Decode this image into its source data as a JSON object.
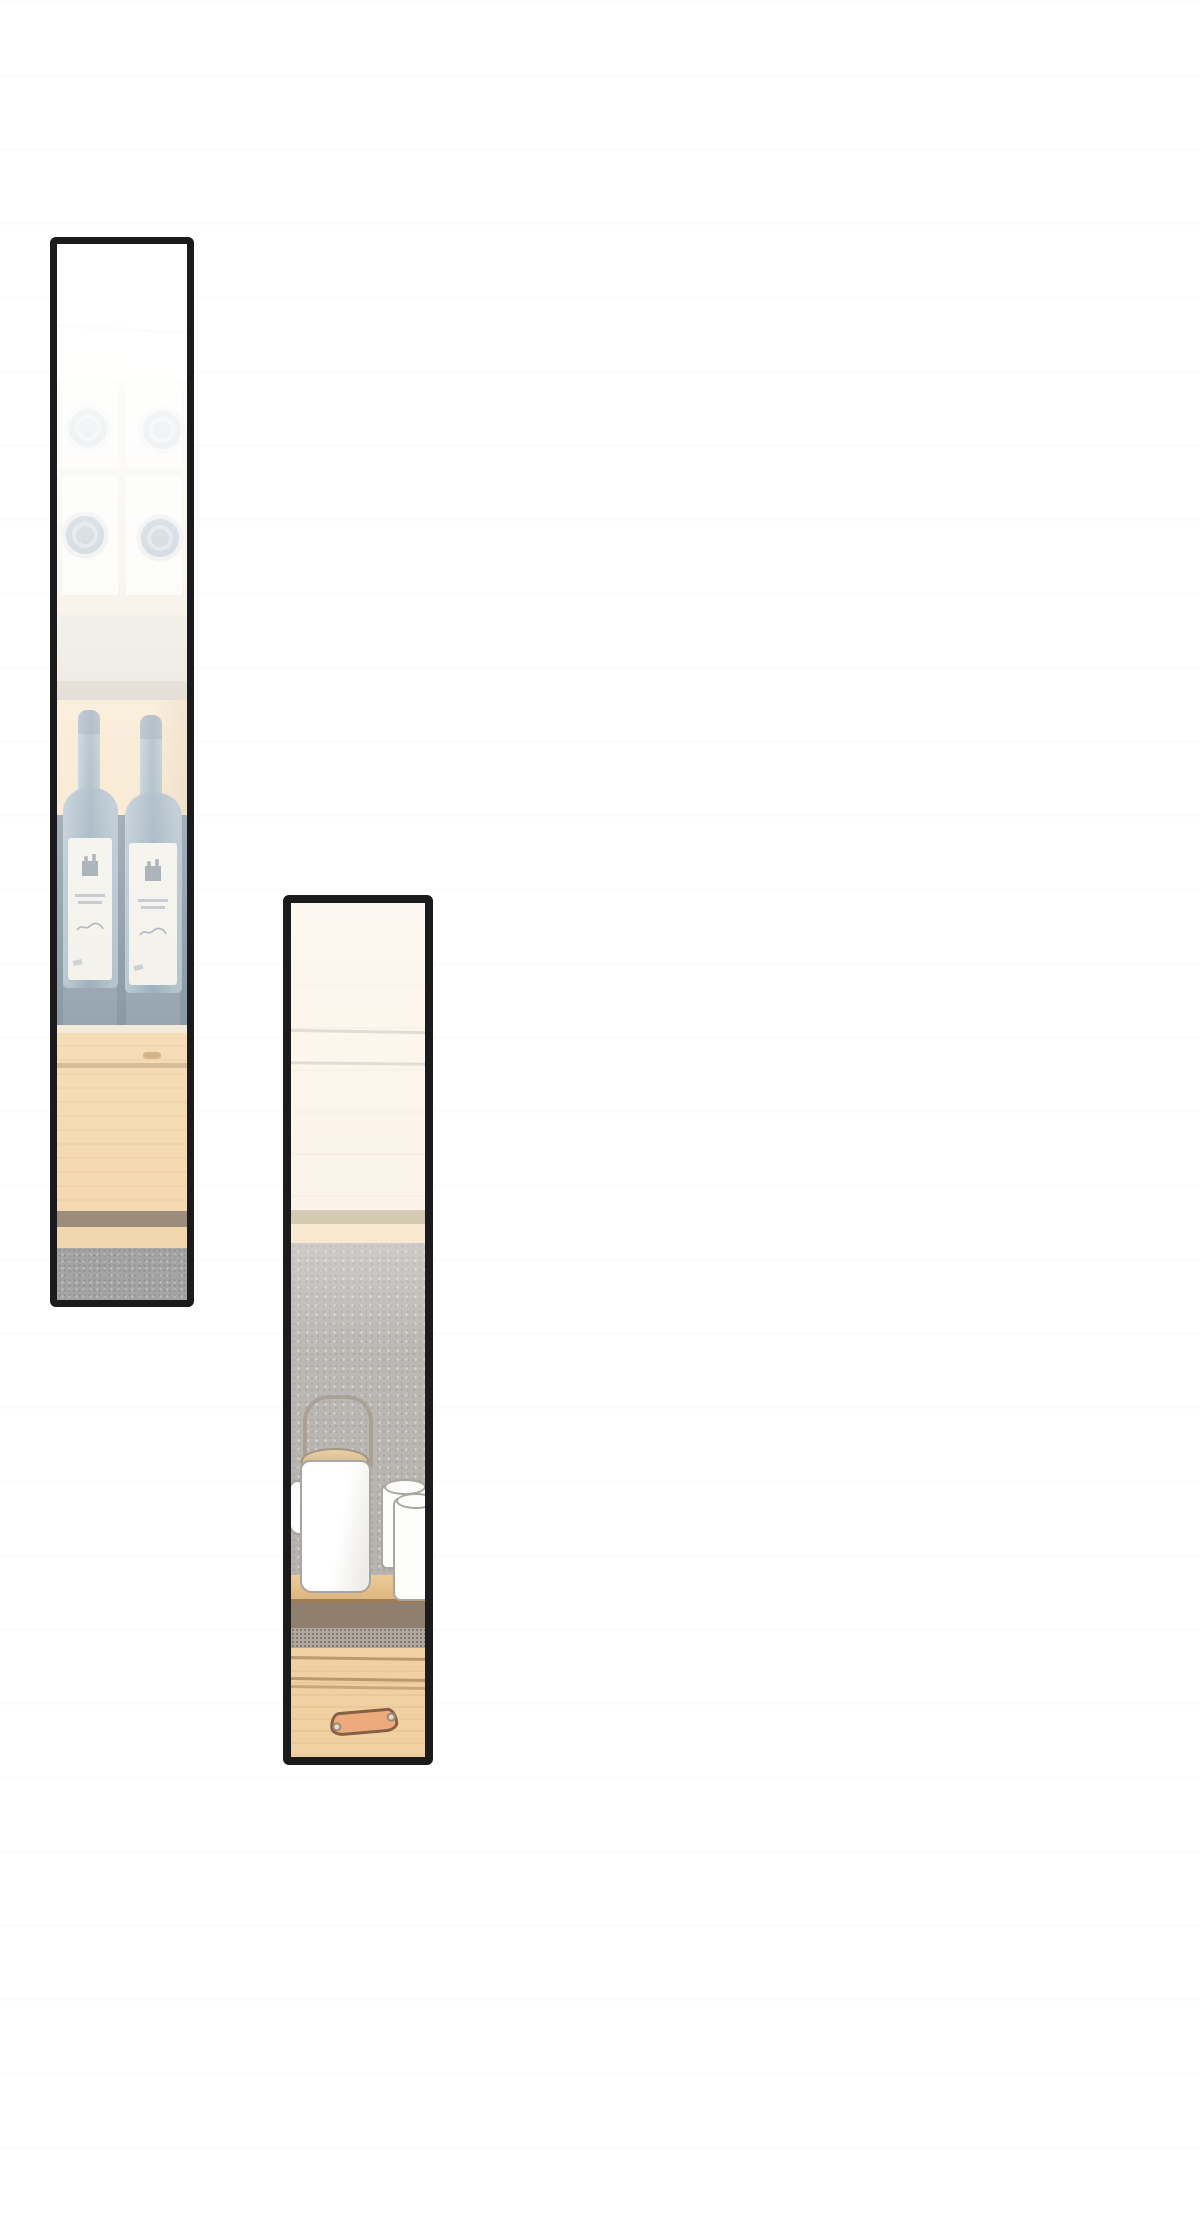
{
  "page": {
    "kind": "webtoon-comic-page",
    "visible_text": "",
    "background": "#ffffff"
  },
  "panels": [
    {
      "name": "wine-shelf-panel",
      "alt": "Tall faded comic panel: wine rack compartments with bottle bottoms, two dark wine bottles with white labels standing in a shelf niche above a wooden counter and gray floor",
      "objects": [
        "wine-rack",
        "wine-bottle",
        "wine-bottle",
        "wood-counter",
        "gray-floor"
      ]
    },
    {
      "name": "tea-counter-panel",
      "alt": "Tall comic panel: white tea kettle with wire handle and wooden lid, small creamer and two white mugs on a wooden counter, gray speckled wall behind, wood drawers with leather handle below",
      "objects": [
        "kettle",
        "creamer",
        "mug",
        "mug",
        "wood-counter",
        "drawer-handle"
      ]
    }
  ],
  "palette": {
    "page_bg": "#ffffff",
    "panel_border": "#1b1b1e",
    "p1_top_white": "#fdfdfb",
    "p1_rack_bg": "#f8f7f3",
    "p1_rack_line": "#efe6d4",
    "p1_bottle_circle": "#748da0",
    "p1_shelf_cream": "#eee5d2",
    "p1_board_light": "#e3dccf",
    "p1_board_dark": "#cfc6b8",
    "p1_wood_warm": "#f6e2c3",
    "p1_niche": "#8c9ba9",
    "p1_niche_shadow": "#7d8d9c",
    "p1_cream_line": "#f2e9d5",
    "p1_counter": "#f5d9b0",
    "p1_counter_groove": "#cdb189",
    "p1_stripe": "#9c8c7b",
    "p1_tan2": "#f2d6ae",
    "p1_floor": "#a4a4a4",
    "p1_bottle_light": "#b3c2cd",
    "p1_bottle_dark": "#8ea4b4",
    "p1_label_bg": "#f2f0e8",
    "p1_label_mark": "#8d97a2",
    "p1_label_line": "#b8bec6",
    "p2_wall_cream": "#faf0e1",
    "p2_wall_line": "#c5bfb4",
    "p2_band_khaki": "#c9bc9e",
    "p2_band_cream": "#f6e3c6",
    "p2_wall_gray": "#b5b1ad",
    "p2_shelf_top": "#ecca96",
    "p2_shelf_bottom": "#d9b078",
    "p2_shelf_edge": "#8f6f4f",
    "p2_band_dark": "#8d7c6c",
    "p2_speckle": "#b0a79d",
    "p2_drawer": "#f1d0a2",
    "p2_groove": "#a5845c",
    "p2_handle": "#edaa7c",
    "p2_handle_outline": "#845f45",
    "p2_rivet": "#e3dacb",
    "p2_ceramic": "#fdfdfc",
    "p2_ceramic_outline": "#a6a29c",
    "p2_lid_light": "#e6cda2",
    "p2_lid_dark": "#c9a979",
    "p2_lid_outline": "#a08f76",
    "p2_wire": "#a39a8f"
  }
}
